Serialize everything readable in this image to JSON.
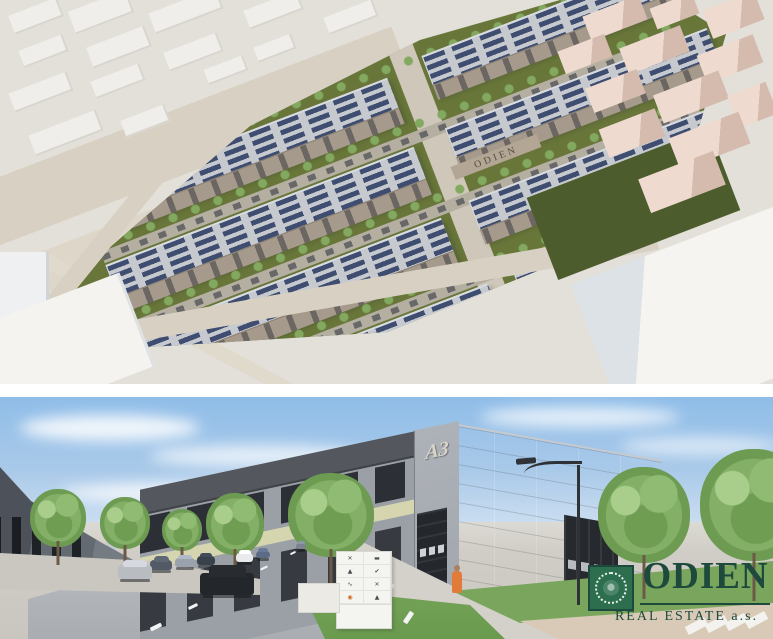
{
  "panels": {
    "aerial": {
      "description": "aerial rendering of industrial park with solar roofs",
      "building_sign": "ODIEN"
    },
    "street": {
      "description": "street-level rendering of warehouse hall",
      "building_label": "A3",
      "tenant_sign_logos": [
        "under-armour",
        "wordmark",
        "adidas",
        "nike",
        "puma",
        "under-armour",
        "certification",
        "adidas"
      ],
      "logo": {
        "brand": "ODIEN",
        "subtitle": "REAL ESTATE a.s."
      }
    }
  },
  "colors": {
    "logo_green": "#1d4a3c",
    "emblem_green": "#2d6e4f",
    "solar_panel_blue": "#3e4d70",
    "lawn_green": "#68763a",
    "sky_blue": "#a9c9e9",
    "facade_accent": "#d5d5b0",
    "facade_gray": "#9ba0a6",
    "context_pink": "#eedacf"
  }
}
